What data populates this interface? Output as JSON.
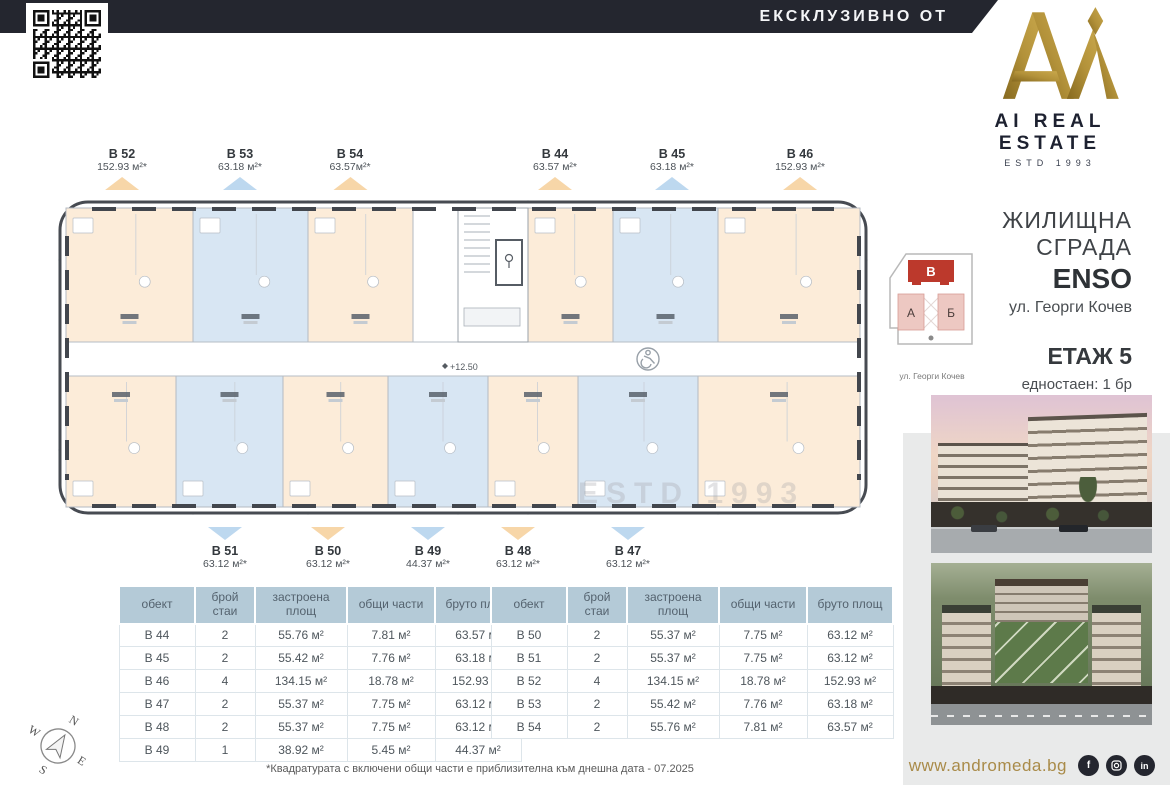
{
  "header": {
    "ribbon": "ЕКСКЛУЗИВНО ОТ",
    "brand": "AI REAL ESTATE",
    "estd": "ESTD 1993"
  },
  "project": {
    "title": "ЖИЛИЩНА СГРАДА",
    "name": "ENSO",
    "address": "ул. Георги Кочев",
    "floor": "ЕТАЖ 5",
    "stats": [
      "едностаен: 1 бр",
      "двустаен: 8 бр",
      "четиристаен: 2 бр"
    ]
  },
  "site_plan": {
    "building_b": "В",
    "building_a": "А",
    "building_g": "Б",
    "street": "ул. Георги Кочев"
  },
  "plan": {
    "level_mark": "+12.50",
    "watermark": "ESTD 1993",
    "top_labels": [
      {
        "id": "В 52",
        "area": "152.93 м²*",
        "tri": "orange"
      },
      {
        "id": "В 53",
        "area": "63.18 м²*",
        "tri": "blue"
      },
      {
        "id": "В 54",
        "area": "63.57м²*",
        "tri": "orange"
      },
      {
        "id": "В 44",
        "area": "63.57 м²*",
        "tri": "orange"
      },
      {
        "id": "В 45",
        "area": "63.18 м²*",
        "tri": "blue"
      },
      {
        "id": "В 46",
        "area": "152.93 м²*",
        "tri": "orange"
      }
    ],
    "bottom_labels": [
      {
        "id": "В 51",
        "area": "63.12 м²*",
        "tri": "blue"
      },
      {
        "id": "В 50",
        "area": "63.12 м²*",
        "tri": "orange"
      },
      {
        "id": "В 49",
        "area": "44.37 м²*",
        "tri": "blue"
      },
      {
        "id": "В 48",
        "area": "63.12 м²*",
        "tri": "orange"
      },
      {
        "id": "В 47",
        "area": "63.12 м²*",
        "tri": "blue"
      }
    ],
    "top_cells": [
      {
        "id": "В 52",
        "color": "cream"
      },
      {
        "id": "В 53",
        "color": "blue"
      },
      {
        "id": "В 54",
        "color": "cream"
      },
      {
        "id": "В 44",
        "color": "cream"
      },
      {
        "id": "В 45",
        "color": "blue"
      },
      {
        "id": "В 46",
        "color": "cream"
      }
    ],
    "bottom_cells": [
      {
        "id": "В 52",
        "color": "cream"
      },
      {
        "id": "В 51",
        "color": "blue"
      },
      {
        "id": "В 50",
        "color": "cream"
      },
      {
        "id": "В 49",
        "color": "blue"
      },
      {
        "id": "В 48",
        "color": "cream"
      },
      {
        "id": "В 47",
        "color": "blue"
      },
      {
        "id": "В 46",
        "color": "cream"
      }
    ]
  },
  "tables": {
    "headers": [
      "обект",
      "брой стаи",
      "застроена площ",
      "общи части",
      "бруто площ"
    ],
    "left_rows": [
      [
        "В 44",
        "2",
        "55.76 м²",
        "7.81 м²",
        "63.57 м²"
      ],
      [
        "В 45",
        "2",
        "55.42 м²",
        "7.76 м²",
        "63.18 м²"
      ],
      [
        "В 46",
        "4",
        "134.15 м²",
        "18.78 м²",
        "152.93 м²"
      ],
      [
        "В 47",
        "2",
        "55.37 м²",
        "7.75 м²",
        "63.12 м²"
      ],
      [
        "В 48",
        "2",
        "55.37 м²",
        "7.75 м²",
        "63.12 м²"
      ],
      [
        "В 49",
        "1",
        "38.92 м²",
        "5.45 м²",
        "44.37 м²"
      ]
    ],
    "right_rows": [
      [
        "В 50",
        "2",
        "55.37 м²",
        "7.75 м²",
        "63.12 м²"
      ],
      [
        "В 51",
        "2",
        "55.37 м²",
        "7.75 м²",
        "63.12 м²"
      ],
      [
        "В 52",
        "4",
        "134.15 м²",
        "18.78 м²",
        "152.93 м²"
      ],
      [
        "В 53",
        "2",
        "55.42 м²",
        "7.76 м²",
        "63.18 м²"
      ],
      [
        "В 54",
        "2",
        "55.76 м²",
        "7.81 м²",
        "63.57 м²"
      ]
    ]
  },
  "footnote": "*Квадратурата с включени общи части е приблизителна към днешна дата - 07.2025",
  "footer": {
    "website": "www.andromeda.bg",
    "social": [
      "f",
      "ig",
      "in"
    ]
  },
  "compass": {
    "n": "N",
    "e": "E",
    "s": "S",
    "w": "W"
  },
  "colors": {
    "navy": "#24262f",
    "gold": "#a3842f",
    "gold_dark": "#86691f",
    "gold_text": "#a98b49",
    "unit_cream": "#fcecd9",
    "unit_blue": "#d8e6f3",
    "tri_orange": "#f7d6a8",
    "tri_blue": "#bdd8ef",
    "site_red": "#bc392c",
    "site_pink": "#edc8c2",
    "table_header": "#b4cad7",
    "side_panel": "#e9eaea"
  }
}
